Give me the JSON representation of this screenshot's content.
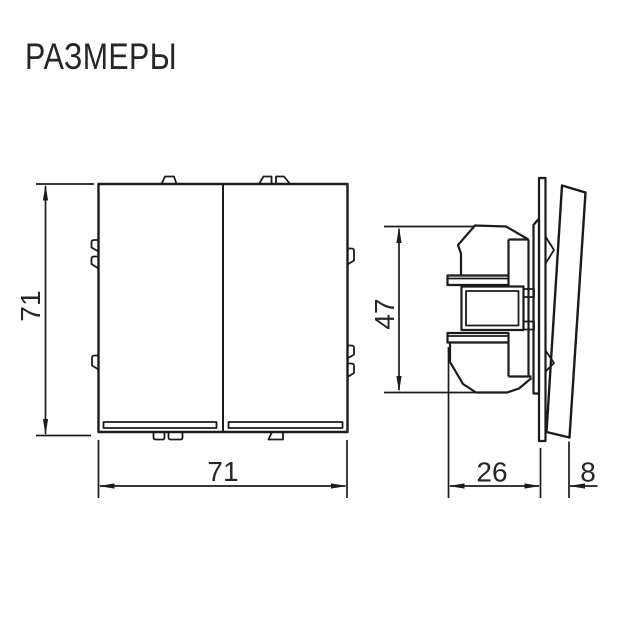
{
  "title": "РАЗМЕРЫ",
  "views": {
    "front": {
      "description": "two-gang switch front view",
      "height_mm": "71",
      "width_mm": "71"
    },
    "side": {
      "description": "switch mechanism side view",
      "mechanism_height_mm": "47",
      "mechanism_depth_mm": "26",
      "rocker_depth_mm": "8"
    }
  },
  "colors": {
    "line": "#1b1b1b",
    "text": "#262626",
    "background": "#ffffff"
  }
}
